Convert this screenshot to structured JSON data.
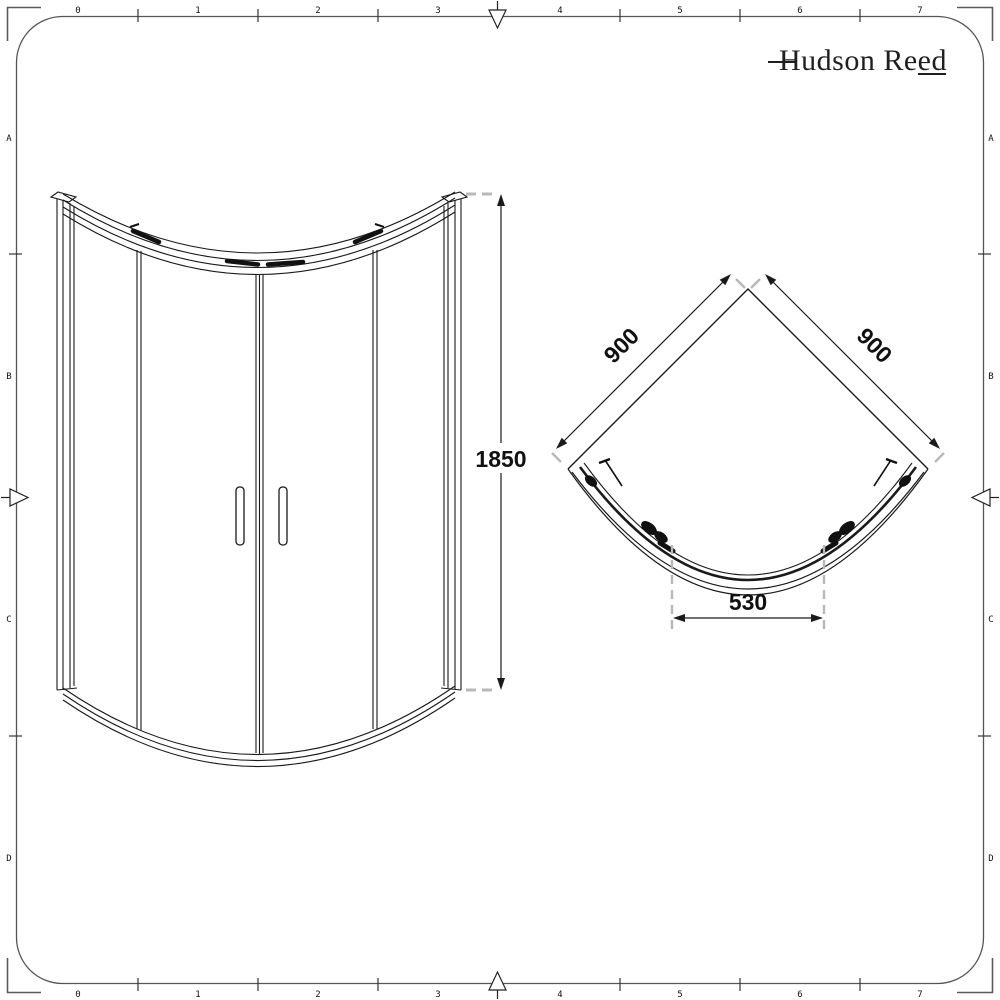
{
  "brand": {
    "name": "Hudson Reed"
  },
  "dimensions": {
    "height_mm": "1850",
    "left_side_mm": "900",
    "right_side_mm": "900",
    "door_opening_mm": "530"
  },
  "rulers": {
    "top": [
      "0",
      "1",
      "2",
      "3",
      "4",
      "5",
      "6",
      "7"
    ],
    "bottom": [
      "0",
      "1",
      "2",
      "3",
      "4",
      "5",
      "6",
      "7"
    ],
    "left": [
      "A",
      "B",
      "C",
      "D"
    ],
    "right": [
      "A",
      "B",
      "C",
      "D"
    ]
  },
  "colors": {
    "line": "#1a1a1a",
    "gray_dash": "#b8b8b8",
    "ruler_line": "#555555",
    "background": "#ffffff"
  }
}
